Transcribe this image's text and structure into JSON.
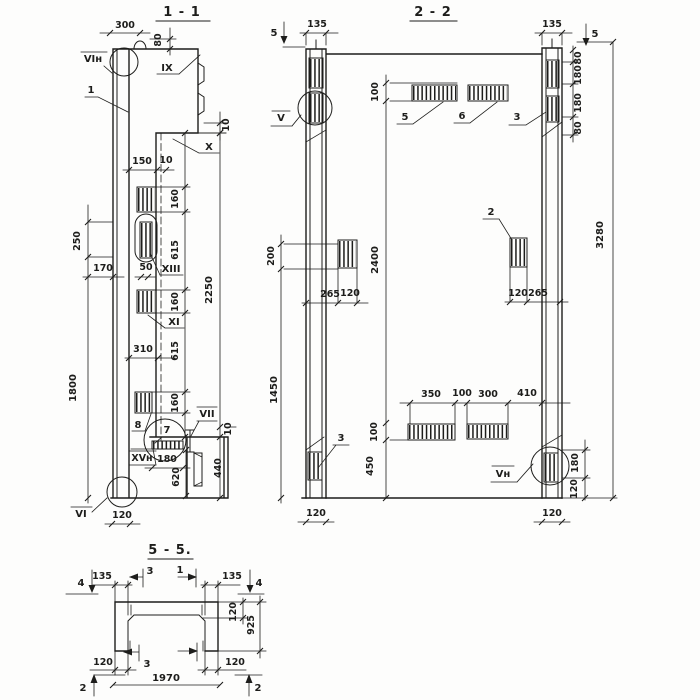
{
  "meta": {
    "background": "#fdfdfc",
    "ink": "#1d1d1b",
    "drawing_type": "structural panel sections"
  },
  "s11": {
    "title": "1 - 1",
    "labels": {
      "vi_n": "VIн",
      "pos1": "1",
      "ix": "IX",
      "x": "X",
      "xiii": "XIII",
      "xi": "XI",
      "pos8": "8",
      "pos7": "7",
      "vii": "VII",
      "xv_n": "XVн",
      "vi": "VI"
    },
    "dims": {
      "w300": "300",
      "h80": "80",
      "t10": "10",
      "w150": "150",
      "w10": "10",
      "r160a": "160",
      "r615a": "615",
      "r160b": "160",
      "r615b": "615",
      "r160c": "160",
      "r2250": "2250",
      "l250": "250",
      "l170": "170",
      "l50": "50",
      "l1800": "1800",
      "w310": "310",
      "t10b": "10",
      "r440": "440",
      "w180": "180",
      "r620": "620",
      "w120": "120"
    }
  },
  "s22": {
    "title": "2 - 2",
    "labels": {
      "v": "V",
      "pos5": "5",
      "pos6": "6",
      "pos3a": "3",
      "pos2": "2",
      "pos3b": "3",
      "v_n": "Vн"
    },
    "dims": {
      "w135l": "135",
      "m5l": "5",
      "w135r": "135",
      "m5r": "5",
      "r80a": "80",
      "r180a": "180",
      "r180b": "180",
      "r80b": "80",
      "r3280": "3280",
      "c100a": "100",
      "c2400": "2400",
      "c100b": "100",
      "c450": "450",
      "l200": "200",
      "l1450": "1450",
      "w265l": "265",
      "w120l": "120",
      "w120r": "120",
      "w265r": "265",
      "b350": "350",
      "b100": "100",
      "b300": "300",
      "b410": "410",
      "r180c": "180",
      "r120c": "120",
      "b120l": "120",
      "b120r": "120"
    }
  },
  "s55": {
    "title": "5 - 5.",
    "dims": {
      "m4l": "4",
      "w135l": "135",
      "m3t": "3",
      "m1t": "1",
      "w135r": "135",
      "m4r": "4",
      "r120": "120",
      "r925": "925",
      "b120l": "120",
      "b120r": "120",
      "m3b": "3",
      "w1970": "1970",
      "m2l": "2",
      "m2r": "2"
    }
  }
}
